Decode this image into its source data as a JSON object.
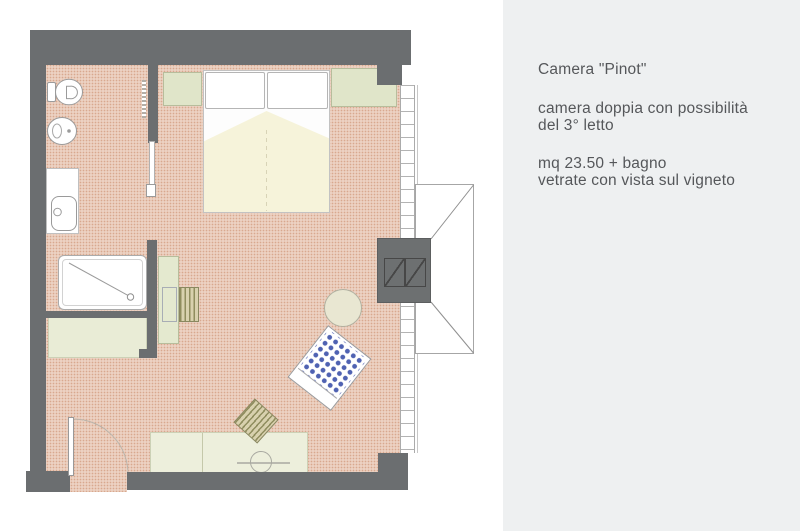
{
  "panel": {
    "title": "Camera \"Pinot\"",
    "description": {
      "line1": "camera doppia con possibilità",
      "line2": "del 3° letto"
    },
    "details": {
      "line1": "mq 23.50 + bagno",
      "line2": "vetrate con vista sul vigneto"
    }
  },
  "plan": {
    "colors": {
      "wall": "#6b6e70",
      "floor_base": "#f4e4d9",
      "floor_dot": "#d9a88e",
      "furniture_green": "#e0e5c9",
      "blanket_cream": "#f6f3da",
      "armchair_dot_blue": "#4f62b2",
      "hatch_olive": "#8f8d5e",
      "panel_background": "#eef0f1",
      "text_gray": "#55575a"
    },
    "elements": [
      "toilet",
      "bidet",
      "washbasin",
      "shower",
      "towel-radiator",
      "double-bed",
      "pillows",
      "nightstand",
      "wardrobe",
      "desk",
      "desk-chair",
      "closet-bench",
      "sideboard",
      "round-table",
      "polka-dot-armchair",
      "lounge-chair",
      "entry-door",
      "sliding-door",
      "window-wall",
      "dormer-window"
    ]
  }
}
